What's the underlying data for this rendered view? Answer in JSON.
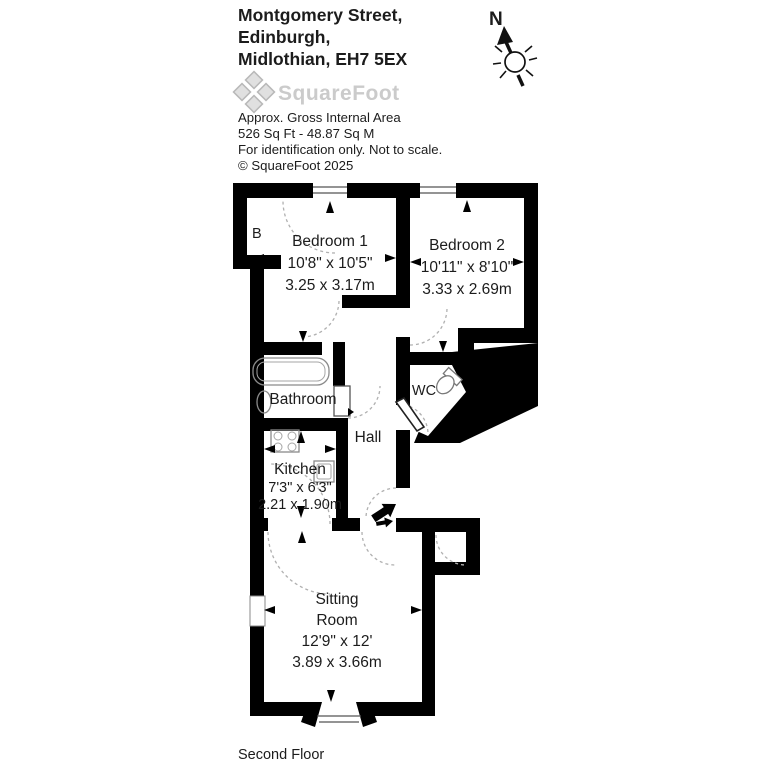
{
  "header": {
    "address_line1": "Montgomery Street,",
    "address_line2": "Edinburgh,",
    "address_line3": "Midlothian, EH7 5EX",
    "logo_text": "SquareFoot",
    "info_line1": "Approx. Gross Internal Area",
    "info_line2": "526 Sq Ft  -  48.87 Sq M",
    "info_line3": "For identification only. Not to scale.",
    "info_line4": "© SquareFoot 2025"
  },
  "compass": {
    "north_label": "N"
  },
  "floorplan": {
    "bedroom1": {
      "name": "Bedroom 1",
      "imperial": "10'8\" x 10'5\"",
      "metric": "3.25 x 3.17m"
    },
    "bedroom2": {
      "name": "Bedroom 2",
      "imperial": "10'11\" x 8'10\"",
      "metric": "3.33 x 2.69m"
    },
    "kitchen": {
      "name": "Kitchen",
      "imperial": "7'3\" x 6'3\"",
      "metric": "2.21 x 1.90m"
    },
    "sitting_room": {
      "name_line1": "Sitting",
      "name_line2": "Room",
      "imperial": "12'9\" x 12'",
      "metric": "3.89 x 3.66m"
    },
    "bathroom": {
      "name": "Bathroom"
    },
    "wc": {
      "name": "WC"
    },
    "hall": {
      "name": "Hall"
    },
    "boiler_cupboard": {
      "name": "B"
    }
  },
  "footer": {
    "floor_label": "Second Floor"
  },
  "colors": {
    "wall": "#000000",
    "logo_gray": "#cbcbcb",
    "door_arc": "#b0b0b0",
    "fixture": "#8a8a8a"
  }
}
